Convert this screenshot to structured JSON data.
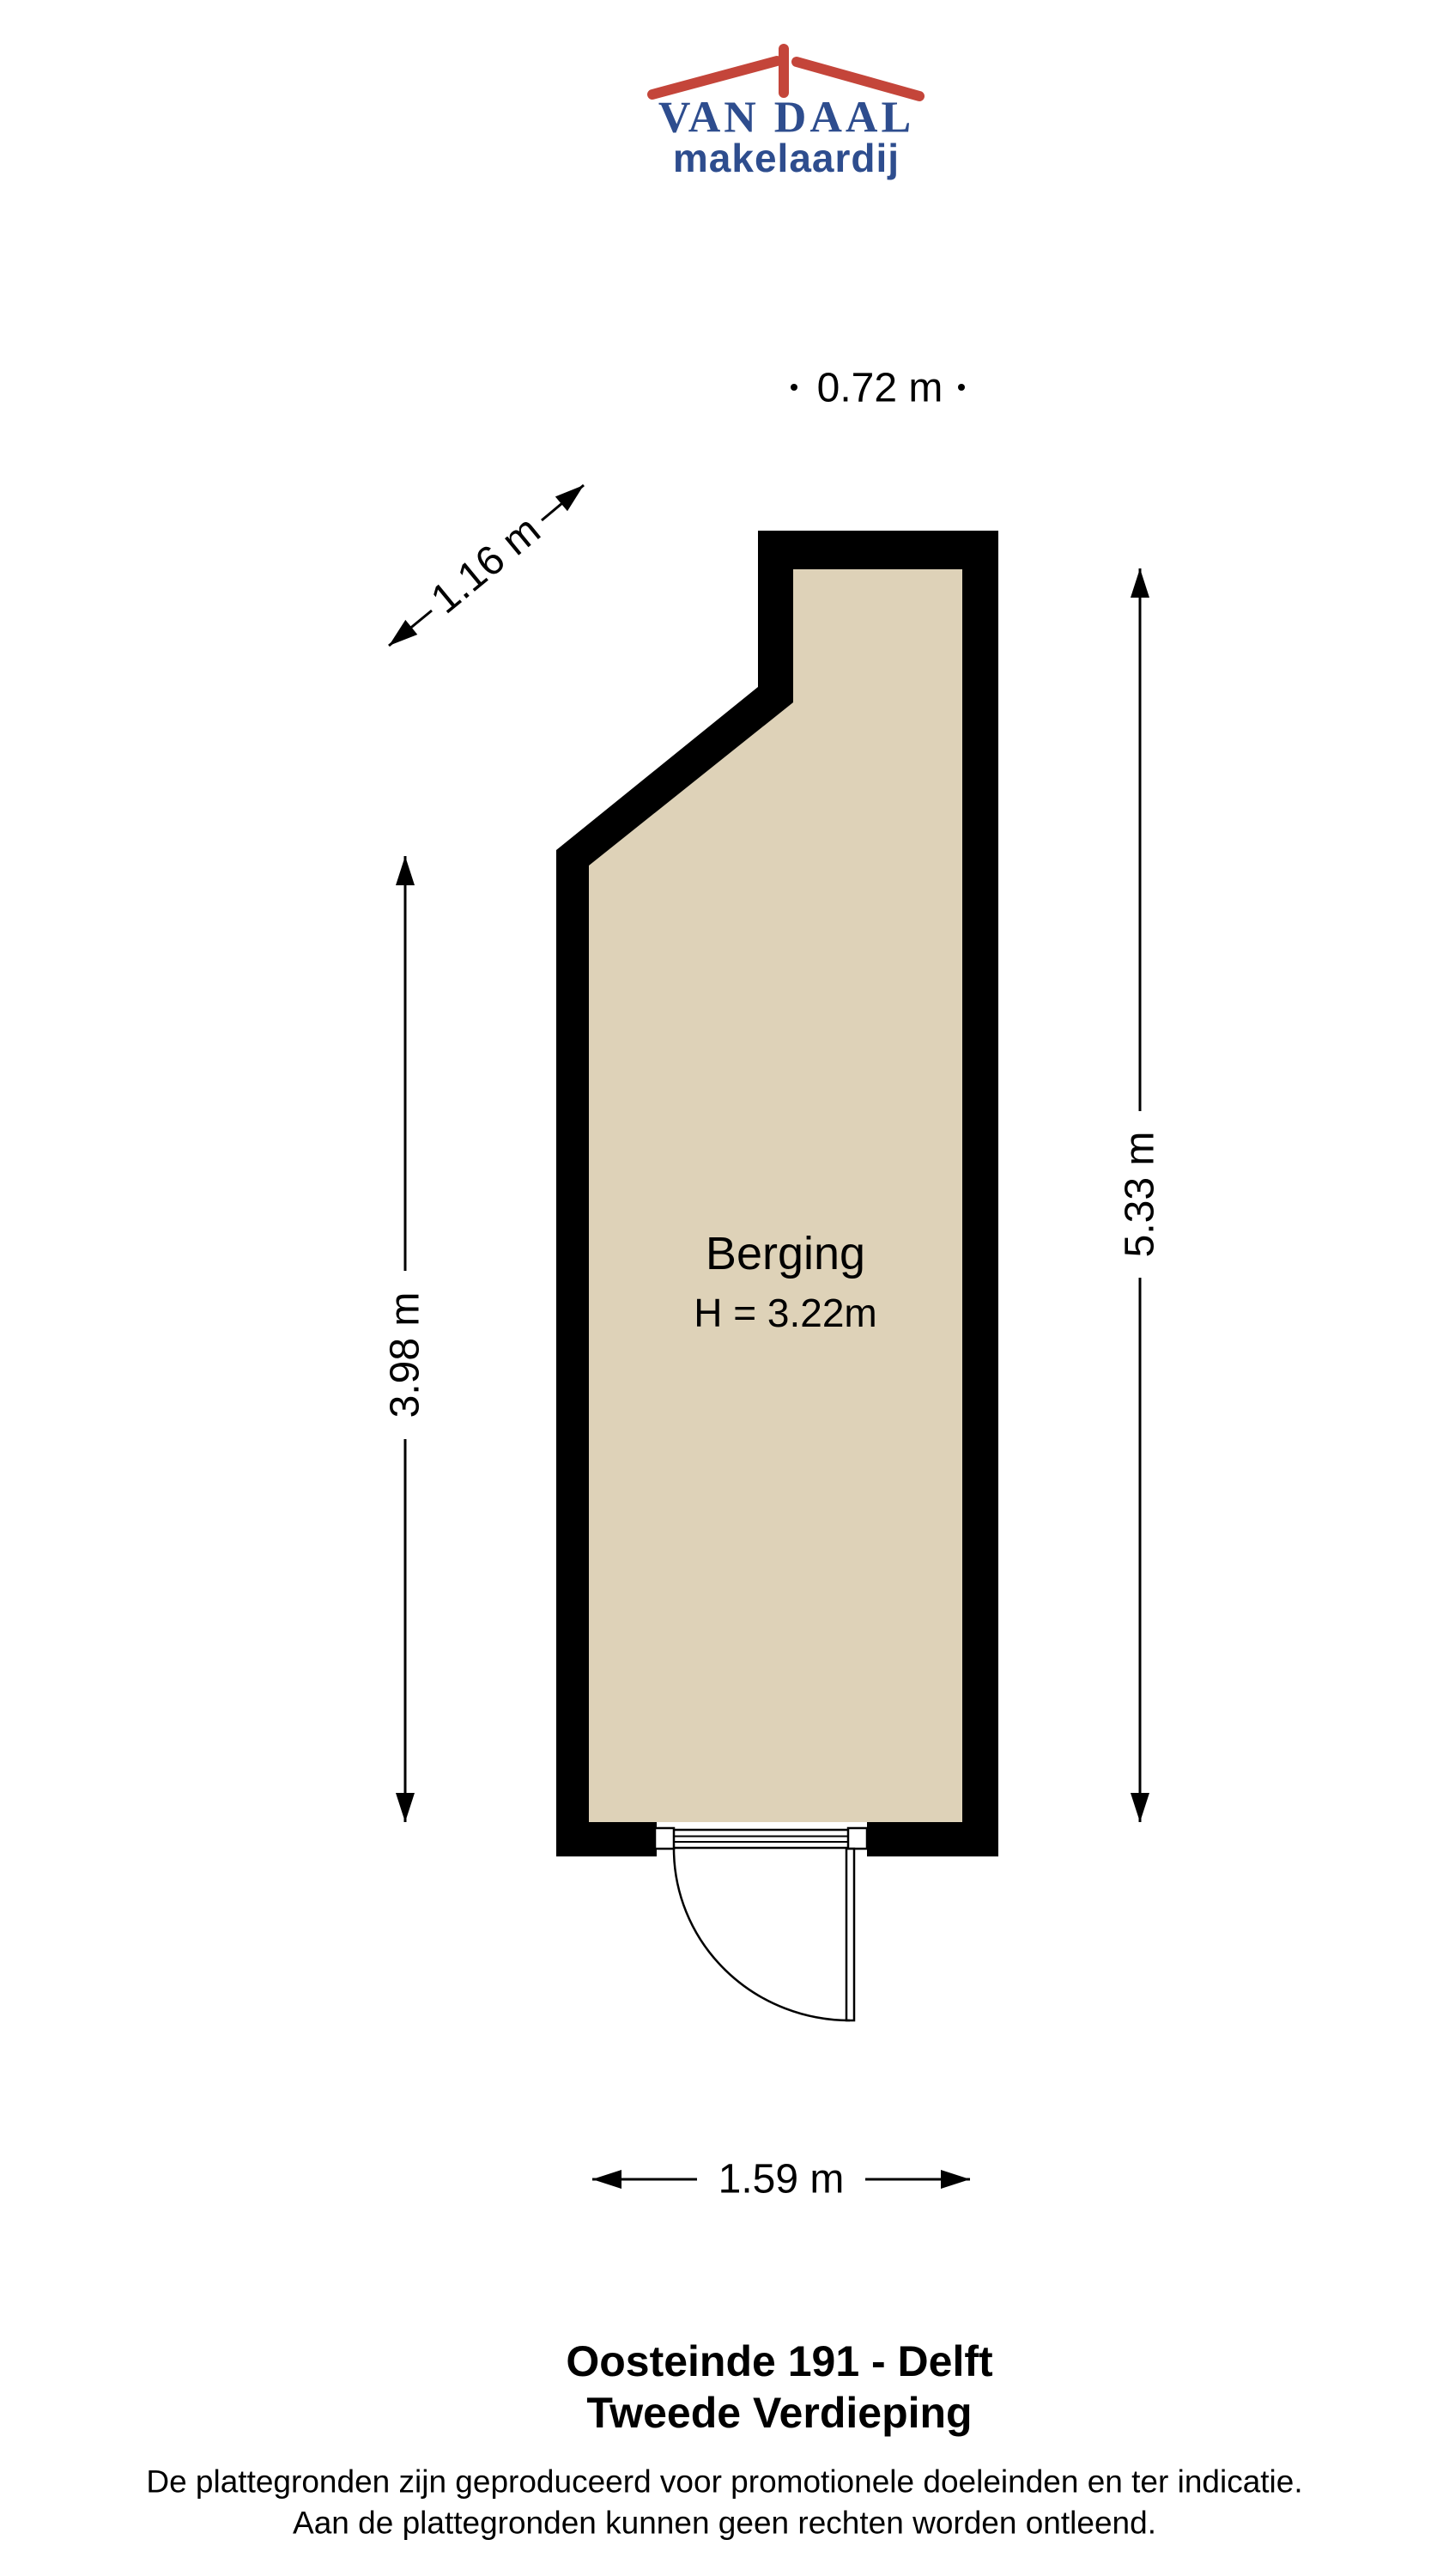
{
  "logo": {
    "name": "VAN DAAL",
    "tagline": "makelaardij",
    "colors": {
      "blue": "#2e4d8e",
      "red": "#c4453a"
    }
  },
  "plan": {
    "room_label": "Berging",
    "room_height": "H = 3.22m",
    "colors": {
      "wall": "#000000",
      "floor": "#ded2b8"
    },
    "dims": {
      "top": "0.72 m",
      "diagonal": "1.16 m",
      "left": "3.98 m",
      "right": "5.33 m",
      "bottom": "1.59 m"
    }
  },
  "footer": {
    "address": "Oosteinde 191 - Delft",
    "floor": "Tweede Verdieping",
    "disclaimer1": "De plattegronden zijn geproduceerd voor promotionele doeleinden en ter indicatie.",
    "disclaimer2": "Aan de plattegronden kunnen geen rechten worden ontleend."
  }
}
